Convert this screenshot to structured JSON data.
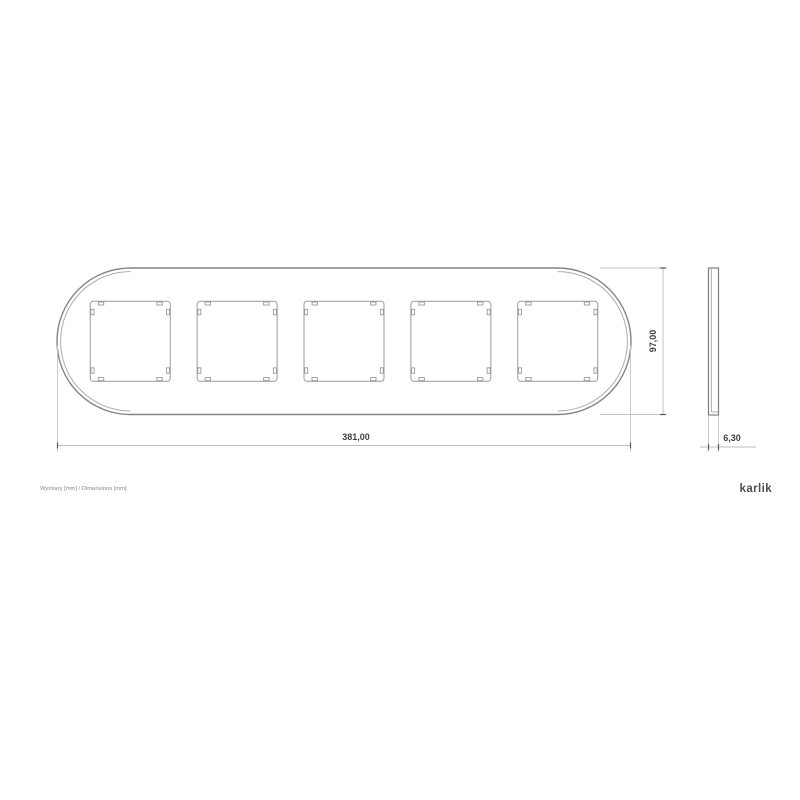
{
  "drawing": {
    "front_view": {
      "module_count": 5
    },
    "dimensions": {
      "width": "381,00",
      "height": "97,00",
      "depth": "6,30"
    },
    "footer_note": "Wymiary [mm] / Dimensions [mm]",
    "brand": "karlik",
    "colors": {
      "part_line": "#848484",
      "dimension_line": "#bcbcbc",
      "label_text": "#3f3f3f"
    }
  }
}
